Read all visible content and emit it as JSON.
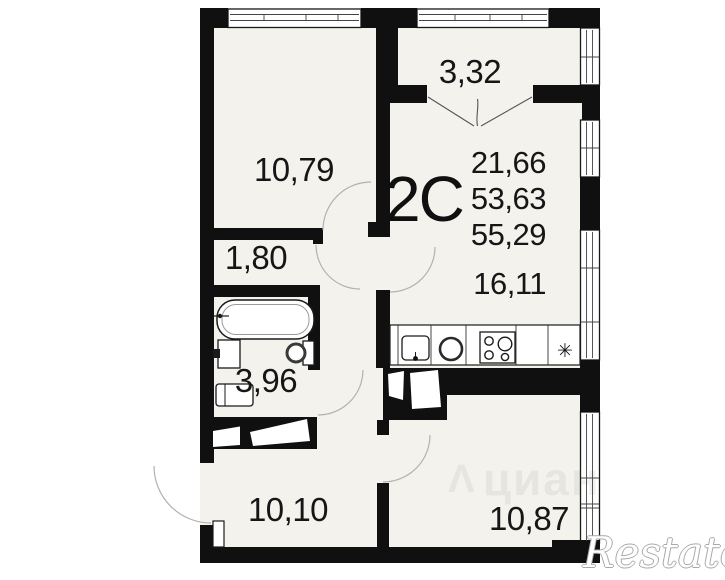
{
  "unit": {
    "type_label": "2С",
    "area_values": [
      "21,66",
      "53,63",
      "55,29",
      "16,11"
    ]
  },
  "rooms": {
    "balcony": "3,32",
    "bedroom": "10,79",
    "hall": "1,80",
    "bathroom": "3,96",
    "room_left": "10,10",
    "room_right": "10,87"
  },
  "symbols": {
    "fridge": "✳"
  },
  "watermarks": {
    "center": "циан",
    "corner": "Restate"
  },
  "colors": {
    "wall": "#101010",
    "floor": "#f4f2ed",
    "line": "#1a1a1a",
    "arc": "#b5b1aa",
    "text": "#161616"
  }
}
